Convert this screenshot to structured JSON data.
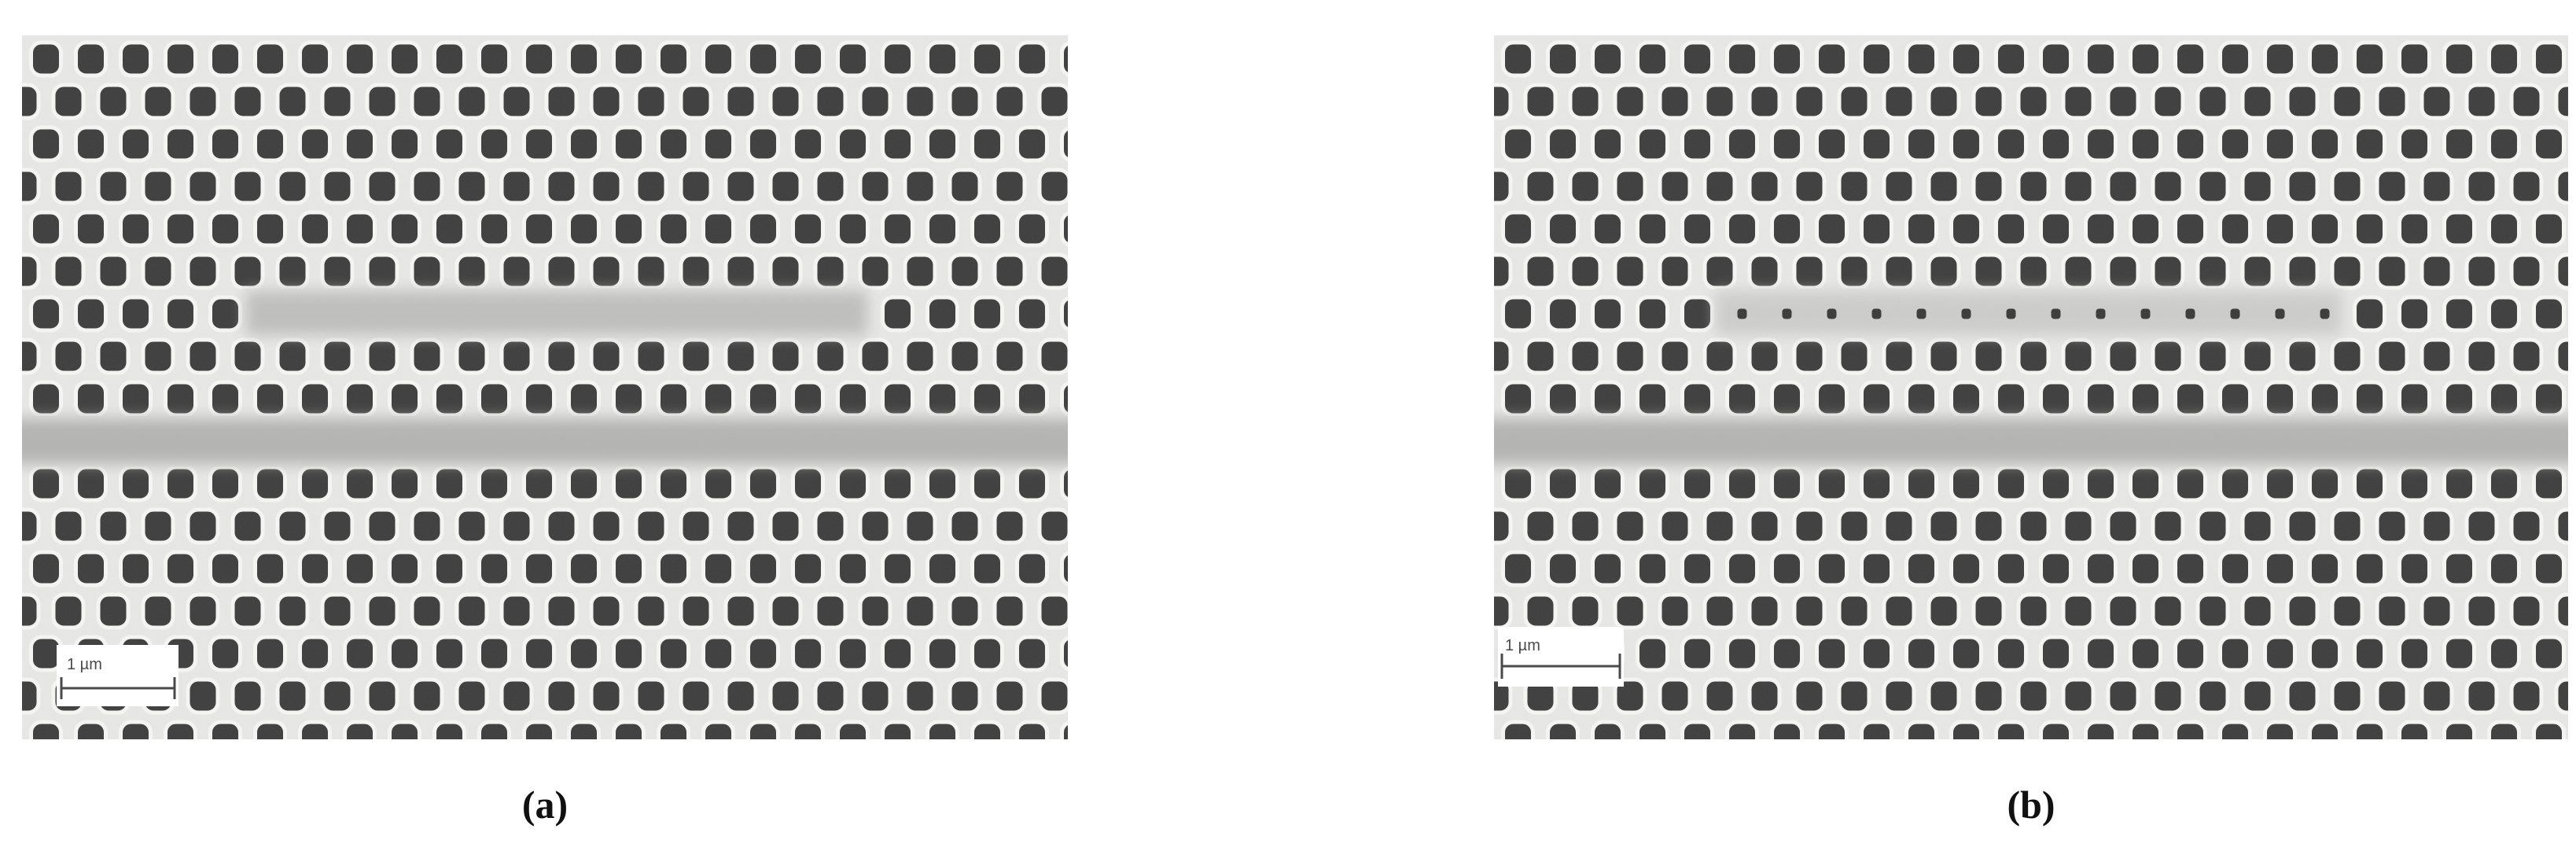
{
  "figure": {
    "panels": [
      {
        "label": "(a)",
        "scale_bar_label": "1 µm"
      },
      {
        "label": "(b)",
        "scale_bar_label": "1 µm"
      }
    ],
    "colors": {
      "membrane": "#e8e8e6",
      "hole": "#3e3e3e",
      "halo": "#f6f6f4",
      "band": "#b3b3b1",
      "smudge_a": "#bdbdbb",
      "smudge_b": "#c9c9c7",
      "dot": "#3a3a3a",
      "scalebar_box": "#ffffff",
      "scalebar_ink": "#4a4a4a",
      "label_ink": "#111111"
    }
  }
}
